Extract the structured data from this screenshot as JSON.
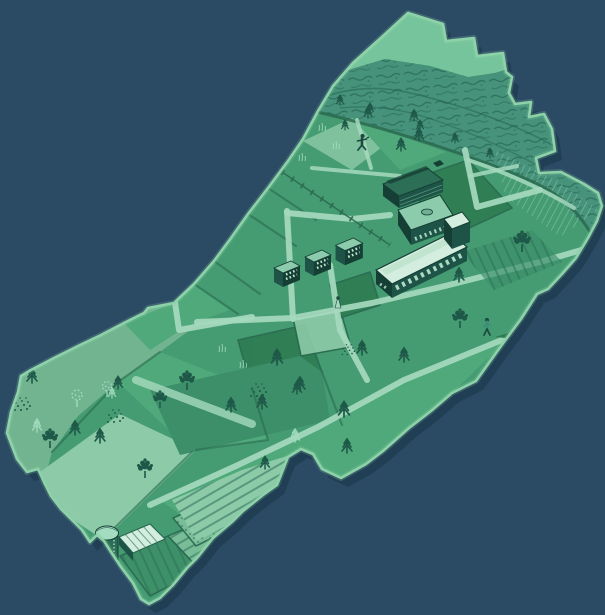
{
  "scene": {
    "type": "illustrated-map",
    "subject": "stylized aerial map of farmland with campus buildings, forest ridge, crop fields, silo, trees and three people",
    "visible_text": ""
  },
  "palette": {
    "background": "#2b4a63",
    "map_shadow": "#1c394f",
    "map_rim": "#8ed2a9",
    "field_base": "#459c72",
    "ridge_light": "#76c49c",
    "forest": "#46927a",
    "forest_texture": "#215f4f",
    "field_bright": "#4fa97a",
    "field_mid2": "#3c8f68",
    "field_dark": "#2d7b51",
    "field_sage": "#72b390",
    "field_mint": "#8ccaa8",
    "field_pale": "#7fc19d",
    "path_light": "#a6d9be",
    "boundary": "#2a6a50",
    "building_dark": "#1d5447",
    "building_darker": "#153f35",
    "roof_light": "#d3edde",
    "roof_mid": "#8ccbab",
    "window_light": "#bfe8d2",
    "tree_dark": "#1e5848",
    "tree_light": "#a3dcc0",
    "row_dark": "#2c6e56",
    "person_dark": "#1c4a41",
    "person_teal": "#3d8f77"
  },
  "landmarks": {
    "ridge": "light hill band along top edge",
    "forest": "dark textured woodland strip",
    "campus": "long white-roofed building with tower, two mid buildings, row of three farmhouses",
    "silo": "round silo with domed top and ribbed barn roof",
    "crop_rows": "striped and dotted crop fields at bottom tip and right side",
    "people_count": 3
  },
  "features": {
    "fir_trees": [
      [
        368,
        118,
        0.8
      ],
      [
        414,
        121,
        0.8
      ],
      [
        419,
        141,
        0.9
      ],
      [
        401,
        151,
        0.9
      ],
      [
        345,
        130,
        0.7
      ],
      [
        459,
        282,
        1
      ],
      [
        404,
        362,
        1
      ],
      [
        362,
        355,
        1
      ],
      [
        344,
        417,
        1.1
      ],
      [
        347,
        453,
        1
      ],
      [
        277,
        365,
        1.1
      ],
      [
        300,
        391,
        1
      ],
      [
        262,
        409,
        1
      ],
      [
        231,
        412,
        1
      ],
      [
        297,
        394,
        0.9
      ],
      [
        265,
        469,
        0.9
      ],
      [
        32,
        383,
        1
      ],
      [
        75,
        435,
        1
      ],
      [
        100,
        443,
        1
      ],
      [
        381,
        468,
        0.8
      ],
      [
        118,
        389,
        0.9
      ],
      [
        340,
        105,
        0.7
      ],
      [
        370,
        113,
        0.7
      ],
      [
        420,
        130,
        0.7
      ],
      [
        455,
        143,
        0.7
      ],
      [
        490,
        158,
        0.7
      ]
    ],
    "light_firs": [
      [
        37,
        432,
        1
      ],
      [
        295,
        442,
        1
      ],
      [
        112,
        398,
        0.8
      ]
    ],
    "round_trees": [
      [
        50,
        448,
        1
      ],
      [
        145,
        478,
        1
      ],
      [
        187,
        390,
        1
      ],
      [
        160,
        408,
        0.9
      ],
      [
        460,
        328,
        1
      ],
      [
        522,
        252,
        1.1
      ]
    ],
    "light_trees": [
      [
        77,
        407,
        1
      ],
      [
        107,
        397,
        0.9
      ]
    ],
    "speckle_bushes": [
      [
        22,
        412,
        1
      ],
      [
        115,
        424,
        1
      ],
      [
        258,
        398,
        1
      ],
      [
        348,
        356,
        0.8
      ]
    ],
    "grass_tufts": [
      [
        322,
        131,
        1
      ],
      [
        336,
        149,
        1
      ],
      [
        302,
        161,
        1
      ],
      [
        222,
        352,
        1
      ],
      [
        243,
        368,
        1
      ]
    ],
    "people_runner": [
      [
        362,
        150,
        1
      ]
    ],
    "people_walker": [
      [
        487,
        335,
        1
      ]
    ],
    "people_stander": [
      [
        338,
        308,
        1
      ]
    ]
  }
}
